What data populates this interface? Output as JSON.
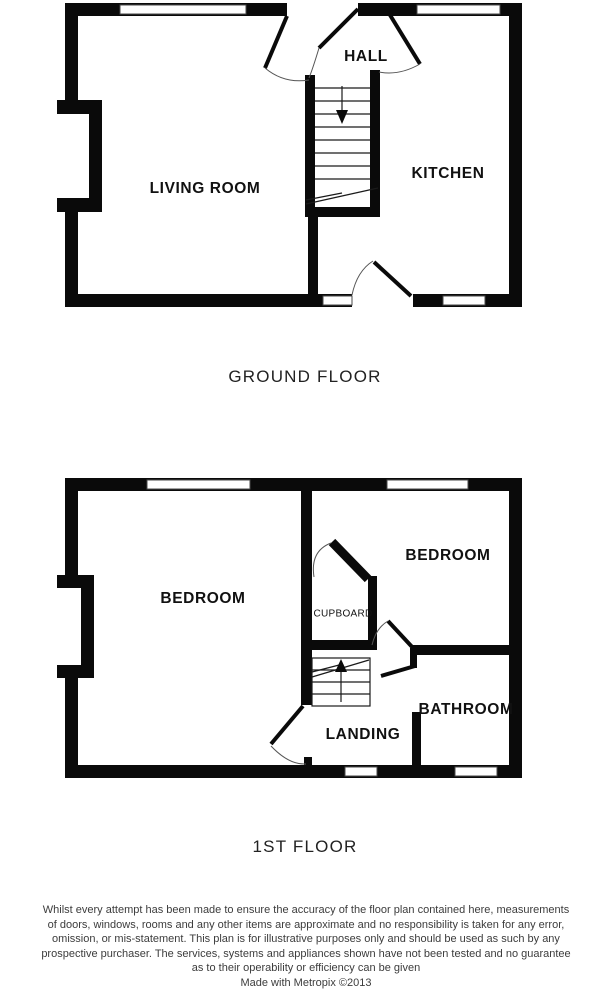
{
  "ground_floor": {
    "caption": "GROUND FLOOR",
    "rooms": {
      "hall": "HALL",
      "living_room": "LIVING ROOM",
      "kitchen": "KITCHEN"
    }
  },
  "first_floor": {
    "caption": "1ST FLOOR",
    "rooms": {
      "bedroom_left": "BEDROOM",
      "bedroom_right": "BEDROOM",
      "cupboard": "CUPBOARD",
      "landing": "LANDING",
      "bathroom": "BATHROOM"
    }
  },
  "disclaimer": {
    "lines": [
      "Whilst every attempt has been made to ensure the accuracy of the floor plan contained here, measurements",
      "of doors, windows, rooms and any other items are approximate and no responsibility is taken for any error,",
      "omission, or mis-statement. This plan is for illustrative purposes only and should be used as such by any",
      "prospective purchaser. The services, systems and appliances shown have not been tested and no guarantee",
      "as to their operability or efficiency can be given"
    ],
    "credit": "Made with Metropix ©2013"
  },
  "colors": {
    "wall": "#0a0a0a",
    "background": "#ffffff",
    "label_text": "#111111",
    "disclaimer_text": "#3c3c3c"
  }
}
